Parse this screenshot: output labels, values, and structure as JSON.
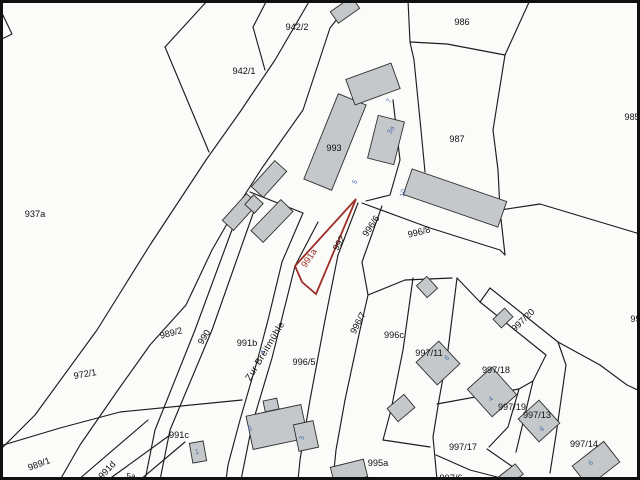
{
  "map": {
    "type": "cadastral-parcel-map",
    "street_label": "Zur Breitmühle",
    "highlighted_parcel": "991a",
    "colors": {
      "highlight_outline": "#9e2f28",
      "parcel_lines": "#1d1d1d",
      "building_fill": "#c5c8ca",
      "house_number_blue": "#4a6fae",
      "background": "#fbfbf9"
    },
    "parcel_labels": [
      {
        "text": "942/2"
      },
      {
        "text": "942/1"
      },
      {
        "text": "986"
      },
      {
        "text": "985"
      },
      {
        "text": "987"
      },
      {
        "text": "937a"
      },
      {
        "text": "993"
      },
      {
        "text": "989/2"
      },
      {
        "text": "990"
      },
      {
        "text": "972/1"
      },
      {
        "text": "991b"
      },
      {
        "text": "991a"
      },
      {
        "text": "992"
      },
      {
        "text": "996/6"
      },
      {
        "text": "996/8"
      },
      {
        "text": "996/7"
      },
      {
        "text": "996/5"
      },
      {
        "text": "996c"
      },
      {
        "text": "997/11"
      },
      {
        "text": "997/20"
      },
      {
        "text": "997/18"
      },
      {
        "text": "997/19"
      },
      {
        "text": "997/13"
      },
      {
        "text": "997/14"
      },
      {
        "text": "997/17"
      },
      {
        "text": "997/6"
      },
      {
        "text": "995a"
      },
      {
        "text": "991c"
      },
      {
        "text": "989/1"
      },
      {
        "text": "991d"
      },
      {
        "text": "5a"
      },
      {
        "text": "997"
      }
    ],
    "house_numbers": [
      {
        "text": "5"
      },
      {
        "text": "3a"
      },
      {
        "text": "10"
      },
      {
        "text": "7"
      },
      {
        "text": "3"
      },
      {
        "text": "5"
      },
      {
        "text": "3"
      },
      {
        "text": "1"
      },
      {
        "text": "6"
      },
      {
        "text": "4"
      },
      {
        "text": "6"
      },
      {
        "text": "6"
      }
    ]
  }
}
